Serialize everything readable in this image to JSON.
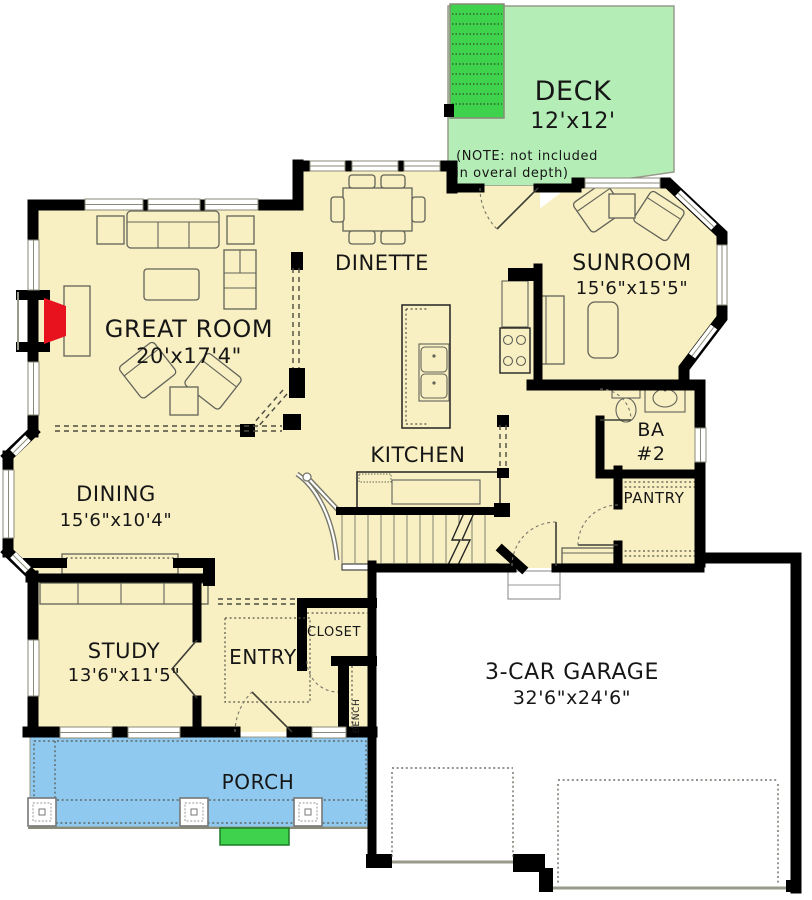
{
  "plan": {
    "title": "First floor plan",
    "rooms": {
      "deck": {
        "name": "DECK",
        "dims": "12'x12'",
        "note1": "(NOTE: not included",
        "note2": "in overal depth)"
      },
      "sunroom": {
        "name": "SUNROOM",
        "dims": "15'6\"x15'5\""
      },
      "dinette": {
        "name": "DINETTE"
      },
      "great_room": {
        "name": "GREAT ROOM",
        "dims": "20'x17'4\""
      },
      "kitchen": {
        "name": "KITCHEN"
      },
      "bath2": {
        "name": "BA",
        "number": "#2"
      },
      "pantry": {
        "name": "PANTRY"
      },
      "dining": {
        "name": "DINING",
        "dims": "15'6\"x10'4\""
      },
      "study": {
        "name": "STUDY",
        "dims": "13'6\"x11'5\""
      },
      "entry": {
        "name": "ENTRY"
      },
      "closet": {
        "name": "CLOSET"
      },
      "bench": {
        "name": "BENCH"
      },
      "garage": {
        "name": "3-CAR GARAGE",
        "dims": "32'6\"x24'6\""
      },
      "porch": {
        "name": "PORCH"
      }
    },
    "colors": {
      "floor": "#f8f0c2",
      "deck": "#b4edb6",
      "stair_green": "#3fd34d",
      "porch": "#8fc9ef",
      "fireplace": "#e8121f",
      "wall": "#000000"
    }
  }
}
